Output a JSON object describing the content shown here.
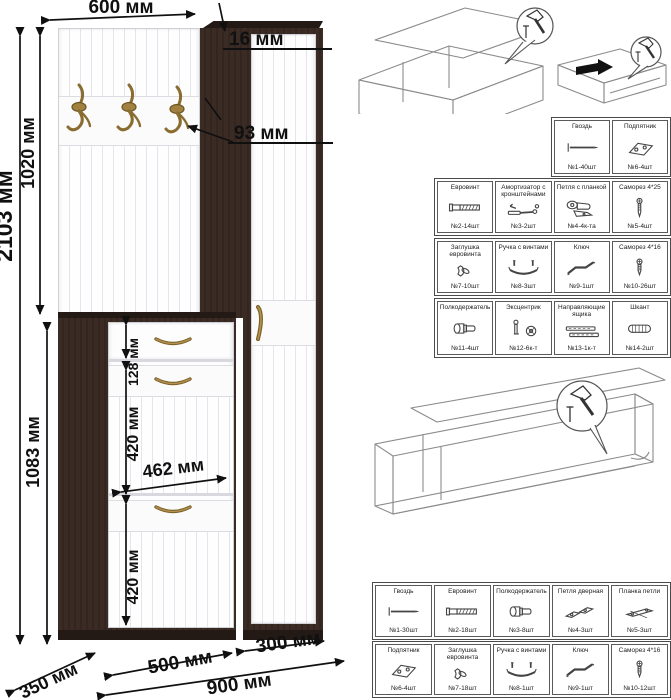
{
  "sheet": {
    "title": "Схема сборки прихожей"
  },
  "dimensions": {
    "top_width": "600 мм",
    "panel_thickness": "16 мм",
    "hook_offset": "93 мм",
    "panel_height": "1020 мм",
    "total_height": "2103 мм",
    "cabinet_height": "1083 мм",
    "drawer_height": "128 мм",
    "flap1_height": "420 мм",
    "inner_width": "462 мм",
    "flap2_height": "420 мм",
    "cabinet_width": "500 мм",
    "wardrobe_width": "300 мм",
    "total_width": "900 мм",
    "depth": "350 мм"
  },
  "parts_table_1": {
    "rows": [
      {
        "cells": [
          {
            "label": "Гвоздь",
            "qty": "№1-40шт",
            "icon": "nail-icon"
          },
          {
            "label": "Подпятник",
            "qty": "№6-4шт",
            "icon": "glide-icon"
          }
        ]
      },
      {
        "cells": [
          {
            "label": "Евровинт",
            "qty": "№2-14шт",
            "icon": "euroscrew-icon"
          },
          {
            "label": "Амортизатор с кронштейнами",
            "qty": "№3-2шт",
            "icon": "strut-icon"
          },
          {
            "label": "Петля с планкой",
            "qty": "№4-4к-та",
            "icon": "hinge-plate-icon"
          },
          {
            "label": "Саморез 4*25",
            "qty": "№5-4шт",
            "icon": "screw-4x25-icon"
          }
        ]
      },
      {
        "cells": [
          {
            "label": "Заглушка евровинта",
            "qty": "№7-10шт",
            "icon": "cap-icon"
          },
          {
            "label": "Ручка с винтами",
            "qty": "№8-3шт",
            "icon": "handle-icon"
          },
          {
            "label": "Ключ",
            "qty": "№9-1шт",
            "icon": "key-icon"
          },
          {
            "label": "Саморез 4*16",
            "qty": "№10-26шт",
            "icon": "screw-4x16-icon"
          }
        ]
      },
      {
        "cells": [
          {
            "label": "Полкодержатель",
            "qty": "№11-4шт",
            "icon": "shelf-pin-icon"
          },
          {
            "label": "Эксцентрик",
            "qty": "№12-6к-т",
            "icon": "eccentric-icon"
          },
          {
            "label": "Направляющие ящика",
            "qty": "№13-1к-т",
            "icon": "drawer-slides-icon"
          },
          {
            "label": "Шкант",
            "qty": "№14-2шт",
            "icon": "dowel-icon"
          }
        ]
      }
    ]
  },
  "parts_table_2": {
    "rows": [
      {
        "cells": [
          {
            "label": "Гвоздь",
            "qty": "№1-30шт",
            "icon": "nail-icon"
          },
          {
            "label": "Евровинт",
            "qty": "№2-18шт",
            "icon": "euroscrew-icon"
          },
          {
            "label": "Полкодержатель",
            "qty": "№3-8шт",
            "icon": "shelf-pin-icon"
          },
          {
            "label": "Петля дверная",
            "qty": "№4-3шт",
            "icon": "door-hinge-icon"
          },
          {
            "label": "Планка петли",
            "qty": "№5-3шт",
            "icon": "hinge-strip-icon"
          }
        ]
      },
      {
        "cells": [
          {
            "label": "Подпятник",
            "qty": "№6-4шт",
            "icon": "glide-icon"
          },
          {
            "label": "Заглушка евровинта",
            "qty": "№7-18шт",
            "icon": "cap-icon"
          },
          {
            "label": "Ручка с винтами",
            "qty": "№8-1шт",
            "icon": "handle-icon"
          },
          {
            "label": "Ключ",
            "qty": "№9-1шт",
            "icon": "key-icon"
          },
          {
            "label": "Саморез 4*16",
            "qty": "№10-12шт",
            "icon": "screw-4x16-icon"
          }
        ]
      }
    ]
  }
}
